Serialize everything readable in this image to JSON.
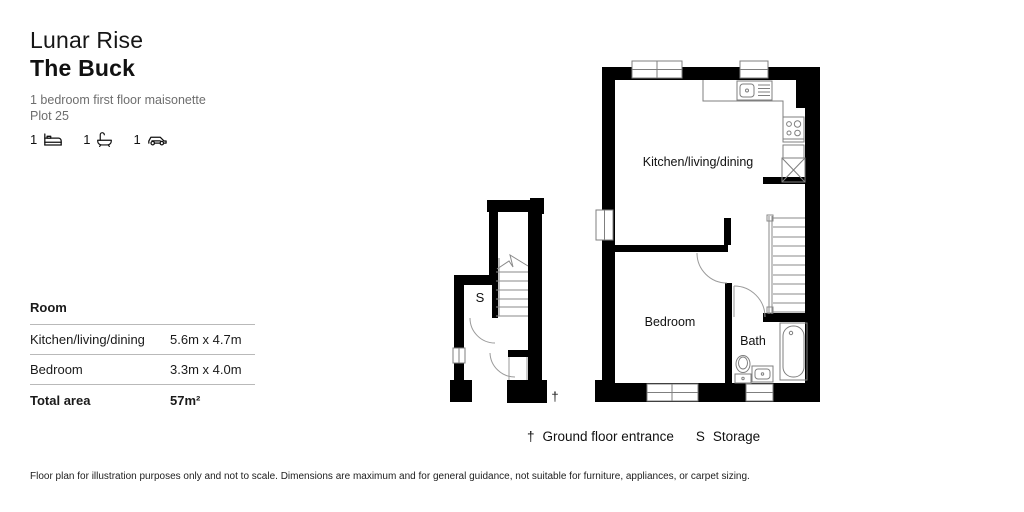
{
  "header": {
    "development": "Lunar Rise",
    "plot_name": "The Buck",
    "description": "1 bedroom first floor maisonette",
    "plot": "Plot 25",
    "features": [
      {
        "count": "1",
        "icon": "bed-icon"
      },
      {
        "count": "1",
        "icon": "bath-icon"
      },
      {
        "count": "1",
        "icon": "car-icon"
      }
    ]
  },
  "room_table": {
    "header": "Room",
    "rows": [
      {
        "room": "Kitchen/living/dining",
        "dims": "5.6m x 4.7m"
      },
      {
        "room": "Bedroom",
        "dims": "3.3m x 4.0m"
      }
    ],
    "total_label": "Total area",
    "total_value": "57m²"
  },
  "floor_plan": {
    "labels": {
      "kitchen": "Kitchen/living/dining",
      "bedroom": "Bedroom",
      "bath": "Bath",
      "storage": "S",
      "entrance_mark": "†"
    }
  },
  "legend": {
    "entries": [
      {
        "symbol": "†",
        "label": "Ground floor entrance"
      },
      {
        "symbol": "S",
        "label": "Storage"
      }
    ]
  },
  "disclaimer": "Floor plan for illustration purposes only and not to scale. Dimensions are maximum and for general guidance, not suitable for furniture, appliances, or carpet sizing.",
  "colors": {
    "wall": "#000000",
    "thin_line": "#7f7f7f",
    "muted_text": "#6e6e6e"
  }
}
